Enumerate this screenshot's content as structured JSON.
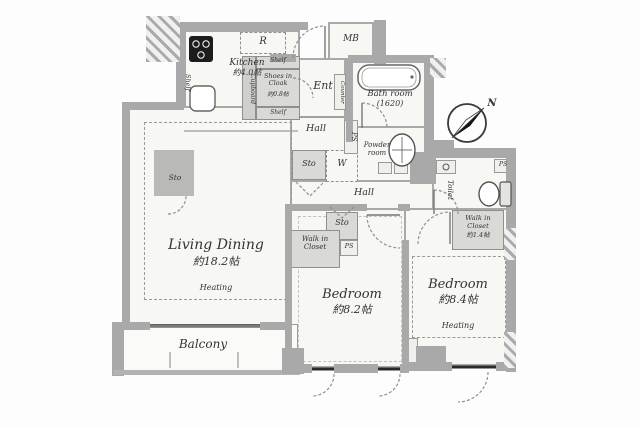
{
  "colors": {
    "wall": "#a9a9a9",
    "floor": "#f7f7f4",
    "closet": "#d9d9d6",
    "window": "#222222"
  },
  "labels": {
    "living": {
      "name": "Living Dining",
      "size": "約18.2帖",
      "heating": "Heating"
    },
    "kitchen": {
      "name": "Kitchen",
      "size": "約4.0帖"
    },
    "bedroom1": {
      "name": "Bedroom",
      "size": "約8.2帖"
    },
    "bedroom2": {
      "name": "Bedroom",
      "size": "約8.4帖",
      "heating": "Heating"
    },
    "bath": {
      "name": "Bath room",
      "size": "(1620)"
    },
    "powder": {
      "name": "Powder room"
    },
    "toilet": {
      "name": "Toilet"
    },
    "ent": {
      "name": "Ent"
    },
    "hall_upper": {
      "name": "Hall"
    },
    "hall_lower": {
      "name": "Hall"
    },
    "balcony": {
      "name": "Balcony"
    },
    "wic_right": {
      "name": "Walk in Closet",
      "size": "約1.4帖"
    },
    "wic_left": {
      "name": "Walk in Closet"
    },
    "cloak": {
      "name": "Shoes in Cloak",
      "size": "約0.8帖"
    },
    "mb": {
      "name": "MB"
    },
    "counter": {
      "name": "Counter"
    },
    "cupboard": {
      "name": "Cupboard"
    },
    "shelf_top": {
      "name": "Shelf"
    },
    "shelf_bottom": {
      "name": "Shelf"
    },
    "shelf_kitchen": {
      "name": "Shelf"
    },
    "sto_living": {
      "name": "Sto"
    },
    "sto_hall": {
      "name": "Sto"
    },
    "sto_bedroom": {
      "name": "Sto"
    },
    "washer": {
      "name": "W"
    },
    "ps_hall": {
      "name": "PS"
    },
    "ps_bedroom": {
      "name": "PS"
    },
    "ps_toilet": {
      "name": "PS"
    },
    "refrigerator": {
      "name": "R"
    },
    "compass": {
      "north": "N"
    }
  }
}
